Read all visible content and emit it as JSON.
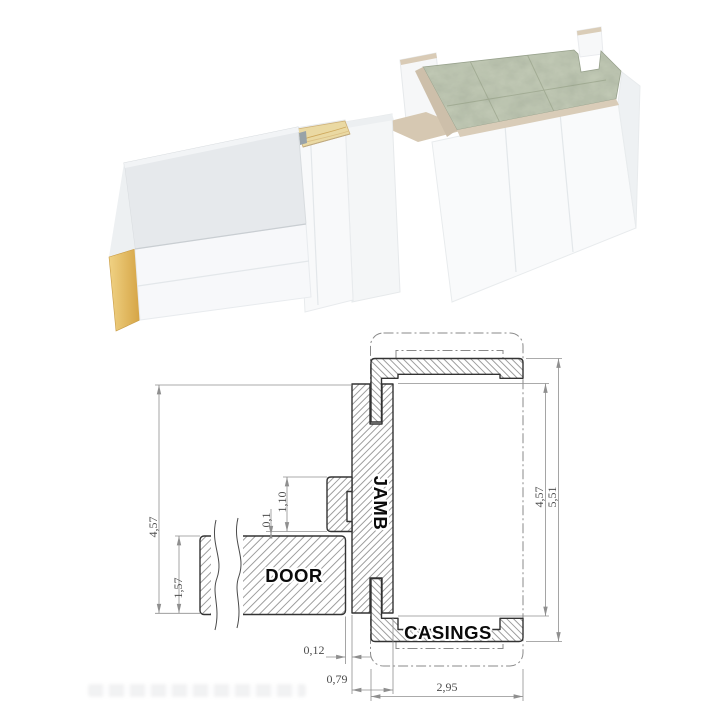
{
  "drawing": {
    "labels": {
      "door": "DOOR",
      "jamb": "JAMB",
      "casings": "CASINGS"
    },
    "dimensions": {
      "jamb_height_left": "4,57",
      "door_thickness": "1,57",
      "doorstop_height": "1,10",
      "door_clearance": "0,1",
      "jamb_height_right": "4,57",
      "casings_overall": "5,51",
      "door_jamb_gap": "0,12",
      "jamb_thickness": "0,79",
      "wall_thickness": "2,95"
    }
  },
  "colors": {
    "outline": "#333333",
    "hatch": "#767676",
    "dimension_lines": "#8f8f8f",
    "label_text": "#0a0a0a",
    "wood_core": "#e0b258",
    "plywood_top": "#ead9a3",
    "stone_top": "#a9b29c",
    "wall_edge_beige": "#d6c8b2",
    "panel_white": "#f8f9fa"
  }
}
